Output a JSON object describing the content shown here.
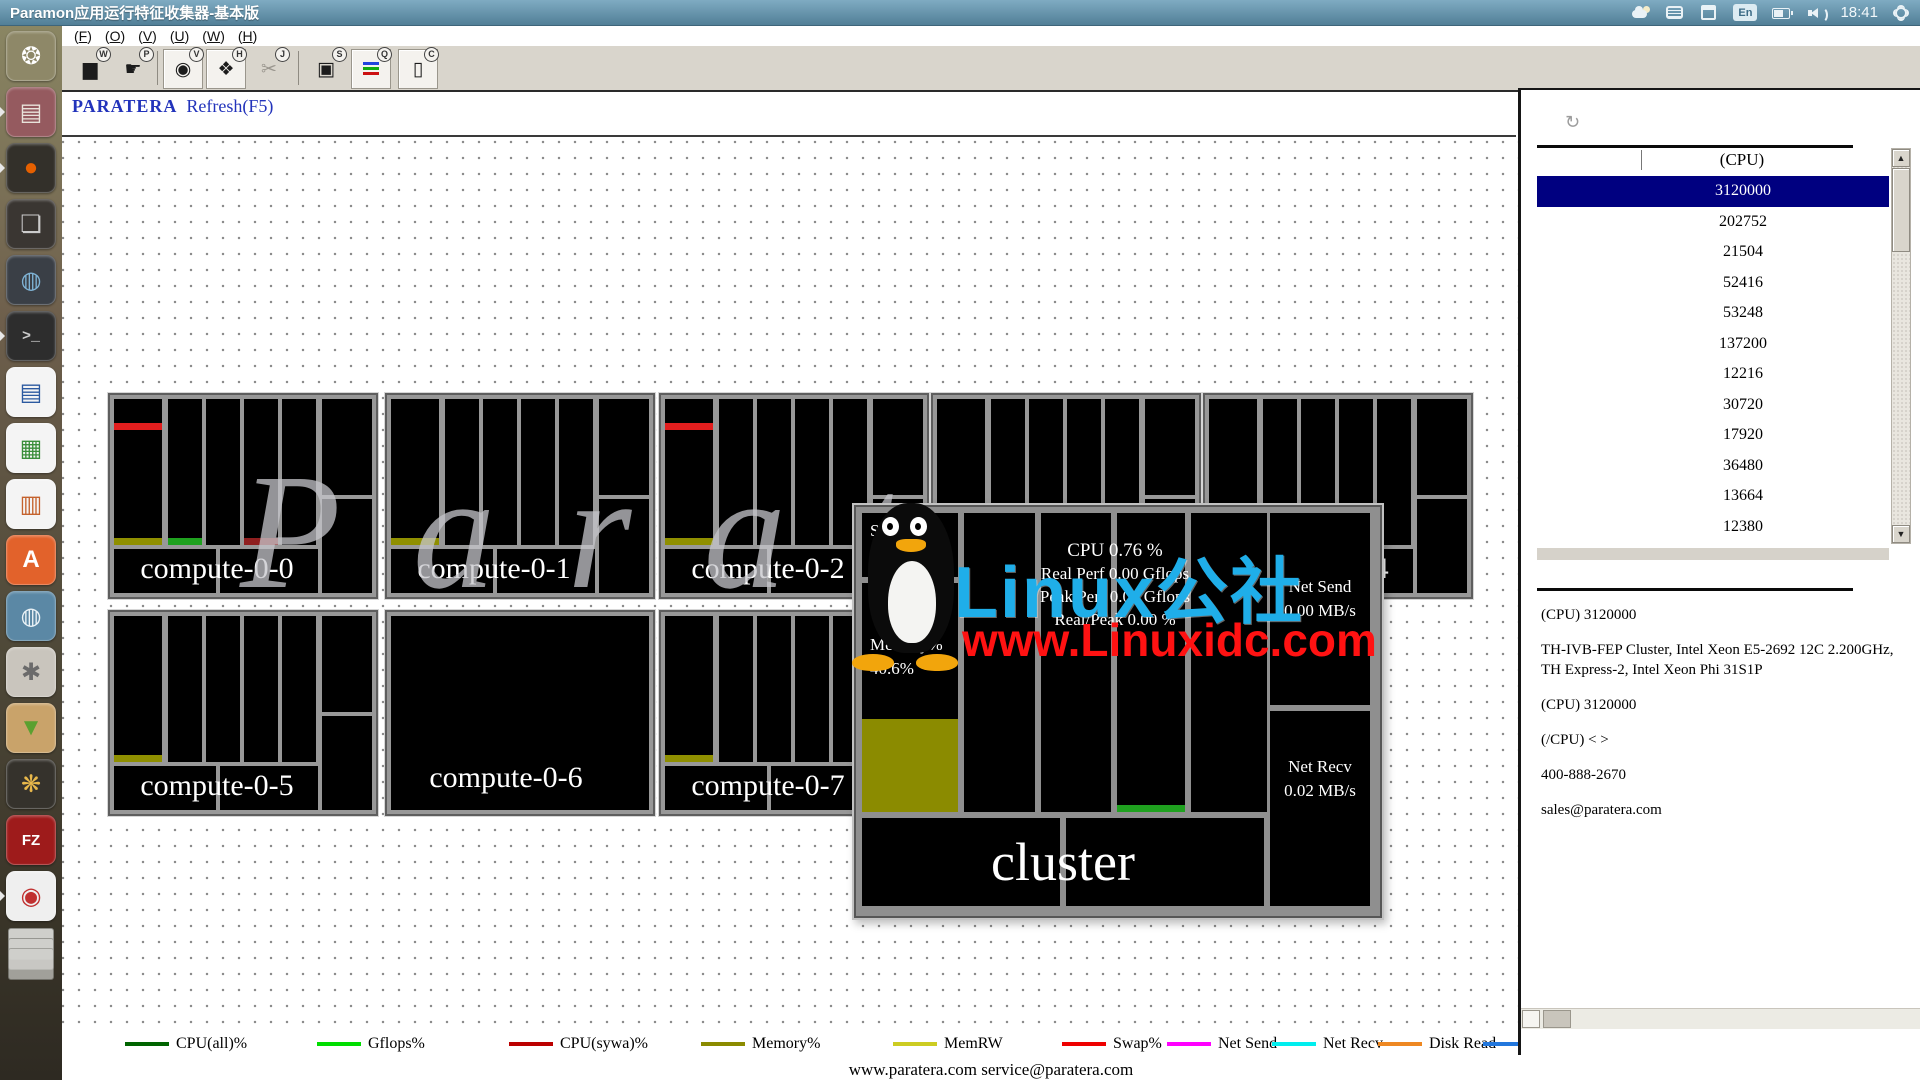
{
  "titlebar": {
    "title": "Paramon应用运行特征收集器-基本版",
    "time": "18:41",
    "lang": "En"
  },
  "menubar": {
    "items": [
      "F",
      "O",
      "V",
      "U",
      "W",
      "H"
    ]
  },
  "toolbar": {
    "buttons": [
      {
        "name": "chart-tool",
        "glyph": "▆",
        "badge": "W",
        "boxed": false,
        "disabled": false
      },
      {
        "name": "pointer-tool",
        "glyph": "☛",
        "badge": "P",
        "boxed": false,
        "disabled": false
      },
      {
        "name": "record-tool",
        "glyph": "◉",
        "badge": "V",
        "boxed": true,
        "disabled": false
      },
      {
        "name": "tag-tool",
        "glyph": "❖",
        "badge": "H",
        "boxed": true,
        "disabled": false
      },
      {
        "name": "cut-tool",
        "glyph": "✂",
        "badge": "J",
        "boxed": false,
        "disabled": true
      },
      {
        "name": "snapshot-tool",
        "glyph": "▣",
        "badge": "S",
        "boxed": false,
        "disabled": false
      },
      {
        "name": "legend-list-tool",
        "glyph": "",
        "badge": "Q",
        "boxed": true,
        "disabled": false
      },
      {
        "name": "clipboard-tool",
        "glyph": "▯",
        "badge": "C",
        "boxed": true,
        "disabled": false
      }
    ]
  },
  "header": {
    "brand": "PARATERA",
    "refresh": "Refresh(F5)"
  },
  "watermarks": {
    "canvas_text": "Paratera",
    "line1": "Linux公社",
    "line2": "www.Linuxidc.com",
    "cyan": "#1faee9",
    "red": "#ff1212"
  },
  "cluster": {
    "title": "cluster",
    "swap_label": "Swap%",
    "swap_value": "0.0 %",
    "memory_label": "Memory%",
    "memory_value": "40.6%",
    "memory_fill_pct": 40.6,
    "cpu_line": "CPU   0.76 %",
    "perf_lines": [
      "Real Perf  0.00 Gflops",
      "Peak Perf  0.00 Gflops",
      "Real/Peak  0.00 %"
    ],
    "net_send_label": "Net Send",
    "net_send_value": "0.00 MB/s",
    "net_recv_label": "Net Recv",
    "net_recv_value": "0.02 MB/s",
    "fill_color": "#8b8b00",
    "strip_green": "#1fa11f"
  },
  "tiles": [
    {
      "label": "compute-0-0",
      "x": 46,
      "y": 256,
      "variant": "grid",
      "left_strips": [
        "top-red",
        "bottom-olive"
      ],
      "col_strips": [
        {
          "col": 0,
          "color": "#1fa11f"
        },
        {
          "col": 2,
          "color": "#8f1f1f"
        }
      ]
    },
    {
      "label": "compute-0-1",
      "x": 323,
      "y": 256,
      "variant": "grid",
      "left_strips": [
        "bottom-olive"
      ],
      "col_strips": []
    },
    {
      "label": "compute-0-2",
      "x": 597,
      "y": 256,
      "variant": "grid",
      "left_strips": [
        "top-red",
        "bottom-olive"
      ],
      "col_strips": []
    },
    {
      "label": "compute-0-3",
      "x": 869,
      "y": 256,
      "variant": "grid",
      "left_strips": [],
      "col_strips": []
    },
    {
      "label": "compute-0-4",
      "x": 1141,
      "y": 256,
      "variant": "grid",
      "left_strips": [],
      "col_strips": []
    },
    {
      "label": "compute-0-5",
      "x": 46,
      "y": 473,
      "variant": "grid",
      "left_strips": [
        "bottom-olive"
      ],
      "col_strips": []
    },
    {
      "label": "compute-0-6",
      "x": 323,
      "y": 473,
      "variant": "solid",
      "left_strips": [],
      "col_strips": []
    },
    {
      "label": "compute-0-7",
      "x": 597,
      "y": 473,
      "variant": "grid",
      "left_strips": [
        "bottom-olive"
      ],
      "col_strips": []
    }
  ],
  "strip_colors": {
    "red": "#e31e1e",
    "olive": "#8f8f00"
  },
  "right_panel": {
    "column_header": "(CPU)",
    "rows": [
      "3120000",
      "202752",
      "21504",
      "52416",
      "53248",
      "137200",
      "12216",
      "30720",
      "17920",
      "36480",
      "13664",
      "12380"
    ],
    "selected_index": 0,
    "selection_color": "#000080",
    "info": [
      "(CPU) 3120000",
      "TH-IVB-FEP Cluster, Intel Xeon E5-2692 12C 2.200GHz, TH Express-2, Intel Xeon Phi 31S1P",
      "(CPU) 3120000",
      "(/CPU) < >",
      "400-888-2670",
      "sales@paratera.com"
    ]
  },
  "legend": [
    {
      "label": "CPU(all)%",
      "color": "#006400",
      "x": 63
    },
    {
      "label": "Gflops%",
      "color": "#00dd00",
      "x": 255
    },
    {
      "label": "CPU(sywa)%",
      "color": "#bb0000",
      "x": 447
    },
    {
      "label": "Memory%",
      "color": "#8b8b00",
      "x": 639
    },
    {
      "label": "MemRW",
      "color": "#cccc22",
      "x": 831
    },
    {
      "label": "Swap%",
      "color": "#ee0000",
      "x": 1000
    },
    {
      "label": "Net Send",
      "color": "#ff00ff",
      "x": 1105
    },
    {
      "label": "Net Recv",
      "color": "#00eeee",
      "x": 1210
    },
    {
      "label": "Disk Read",
      "color": "#ee8822",
      "x": 1316
    },
    {
      "label": "Disk Write",
      "color": "#2277dd",
      "x": 1421
    }
  ],
  "footer": "www.paratera.com service@paratera.com",
  "launcher": [
    {
      "name": "ubuntu-dash",
      "glyph": "❂",
      "bg": "#8e8868",
      "fg": "#ffffff",
      "running": false
    },
    {
      "name": "file-manager",
      "glyph": "▤",
      "bg": "#955a5f",
      "fg": "#e8e2da",
      "running": true
    },
    {
      "name": "firefox",
      "glyph": "●",
      "bg": "#33302a",
      "fg": "#e66000",
      "running": true
    },
    {
      "name": "workspace-switcher",
      "glyph": "❏",
      "bg": "#3a3632",
      "fg": "#cccccc",
      "running": false
    },
    {
      "name": "chromium",
      "glyph": "◍",
      "bg": "#3a3f46",
      "fg": "#7fb3d5",
      "running": false
    },
    {
      "name": "terminal",
      "glyph": ">_",
      "bg": "#2d2d2d",
      "fg": "#cccccc",
      "running": true
    },
    {
      "name": "libreoffice-writer",
      "glyph": "▤",
      "bg": "#f4f4f4",
      "fg": "#2c5aa0",
      "running": false
    },
    {
      "name": "libreoffice-calc",
      "glyph": "▦",
      "bg": "#f4f4f4",
      "fg": "#3a8e3a",
      "running": false
    },
    {
      "name": "libreoffice-impress",
      "glyph": "▥",
      "bg": "#f4f4f4",
      "fg": "#c4622d",
      "running": false
    },
    {
      "name": "software-center",
      "glyph": "A",
      "bg": "#e2622b",
      "fg": "#ffffff",
      "running": false
    },
    {
      "name": "software-updater",
      "glyph": "◍",
      "bg": "#5b88a5",
      "fg": "#eaf2f6",
      "running": false
    },
    {
      "name": "system-settings",
      "glyph": "✱",
      "bg": "#c9c5bd",
      "fg": "#6b6b6b",
      "running": false
    },
    {
      "name": "package-installer",
      "glyph": "▼",
      "bg": "#c9a36a",
      "fg": "#5ba030",
      "running": false
    },
    {
      "name": "photo-manager",
      "glyph": "❋",
      "bg": "#35322c",
      "fg": "#e8b84b",
      "running": false
    },
    {
      "name": "filezilla",
      "glyph": "FZ",
      "bg": "#9e1b1b",
      "fg": "#ffffff",
      "running": false
    },
    {
      "name": "document-viewer",
      "glyph": "◉",
      "bg": "#efefef",
      "fg": "#c03030",
      "running": true
    }
  ]
}
